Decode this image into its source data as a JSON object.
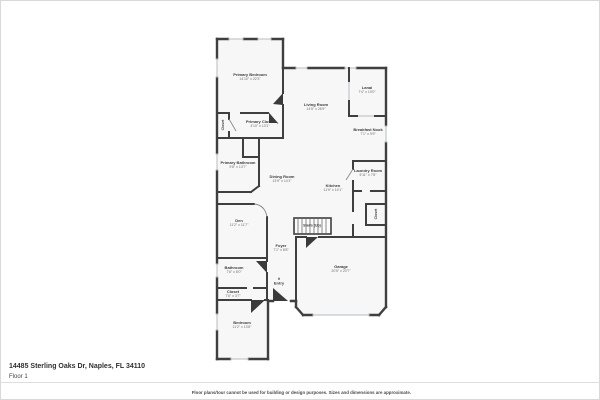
{
  "colors": {
    "wall": "#3f3f3f",
    "room_fill": "#f7f7f7",
    "window_line": "#b6bcc2",
    "label_text": "#3c3c3c",
    "dims_text": "#6e6e6e",
    "border": "#d9d9d9"
  },
  "rooms": [
    {
      "label": "Primary Bedroom",
      "dims": "14'10\" x 22'3\""
    },
    {
      "label": "Living Room",
      "dims": "14'5\" x 26'9\""
    },
    {
      "label": "Lanai",
      "dims": "7'4\" x 10'0\""
    },
    {
      "label": "Breakfast Nook",
      "dims": "7'1\" x 9'9\""
    },
    {
      "label": "Primary Closet",
      "dims": "4'10\" x 13'1\""
    },
    {
      "label": "Primary Bathroom",
      "dims": "9'8\" x 13'7\""
    },
    {
      "label": "Dining Room",
      "dims": "13'9\" x 14'1\""
    },
    {
      "label": "Kitchen",
      "dims": "11'9\" x 14'1\""
    },
    {
      "label": "Laundry Room",
      "dims": "5'11\" x 7'8\""
    },
    {
      "label": "Den",
      "dims": "11'2\" x 11'7\""
    },
    {
      "label": "Stairs (Up)",
      "dims": ""
    },
    {
      "label": "Foyer",
      "dims": "7'1\" x 8'8\""
    },
    {
      "label": "Bathroom",
      "dims": "7'6\" x 8'0\""
    },
    {
      "label": "Closet",
      "dims": "7'6\" x 3'7\""
    },
    {
      "label": "Entry",
      "dims": ""
    },
    {
      "label": "Garage",
      "dims": "20'5\" x 20'7\""
    },
    {
      "label": "Bedroom",
      "dims": "11'2\" x 13'8\""
    }
  ],
  "vertical_labels": [
    {
      "label": "Closet"
    },
    {
      "label": "Closet"
    }
  ],
  "icons": {
    "entry_arrow": "▲"
  },
  "footer": {
    "address": "14485 Sterling Oaks Dr, Naples, FL 34110",
    "floor": "Floor 1",
    "disclaimer": "Floor plans/tour cannot be used for building or design purposes. Sizes and dimensions are approximate."
  }
}
